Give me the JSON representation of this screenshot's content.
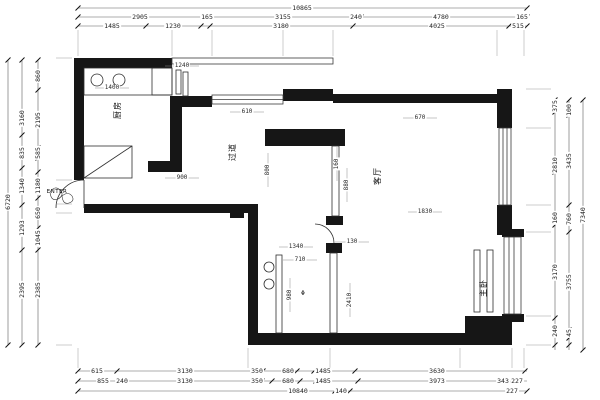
{
  "document": {
    "type": "architectural floor plan (CAD dimension drawing)"
  },
  "colors": {
    "wall": "#161616",
    "thin_line": "#2e2e2e",
    "dim_line": "#5a5a5a",
    "text": "#1f1f1f",
    "background": "#ffffff"
  },
  "rooms": [
    {
      "id": "kitchen",
      "label": "厨房"
    },
    {
      "id": "hallway",
      "label": "过道"
    },
    {
      "id": "living-room",
      "label": "客厅"
    },
    {
      "id": "master-bedroom",
      "label": "主卧"
    },
    {
      "id": "entry",
      "label": "ENTER"
    }
  ],
  "symbols": {
    "floor_drain": "Φ"
  },
  "dimensions": {
    "top": {
      "row1": [
        "10865"
      ],
      "row2": [
        "2905",
        "165",
        "3155",
        "240",
        "4780",
        "165"
      ],
      "row3": [
        "1485",
        "1230",
        "3180",
        "4025",
        "515"
      ]
    },
    "bottom": {
      "row1": [
        "615",
        "3130",
        "350",
        "680",
        "1485",
        "3630"
      ],
      "row2": [
        "855",
        "240",
        "3130",
        "350",
        "680",
        "1485",
        "3973",
        "343",
        "227"
      ],
      "row3": [
        "10840",
        "140",
        "227"
      ]
    },
    "left": {
      "outer": [
        "6720"
      ],
      "middle": [
        "3160",
        "835",
        "1340",
        "1293",
        "2395"
      ],
      "inner": [
        "860",
        "2195",
        "585",
        "1180",
        "650",
        "1045",
        "2385"
      ]
    },
    "right": {
      "inner": [
        "375",
        "2810",
        "160",
        "3170",
        "240"
      ],
      "middle": [
        "100",
        "3435",
        "760",
        "3755",
        "45"
      ],
      "outer": [
        "7340"
      ]
    },
    "interior": [
      "1400",
      "1240",
      "610",
      "900",
      "1340",
      "130",
      "710",
      "880",
      "980",
      "670",
      "800",
      "160",
      "2410",
      "1830"
    ]
  }
}
